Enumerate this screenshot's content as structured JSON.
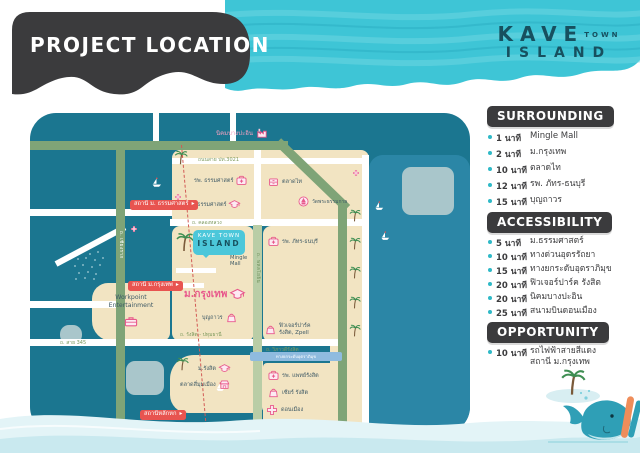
{
  "colors": {
    "accent_cyan": "#3ec5d6",
    "dark": "#3b3b3d",
    "map_water": "#1b7690",
    "land": "#f2e4c2",
    "pink": "#e8598c",
    "badge_red": "#e85450",
    "road_green": "#7fa477"
  },
  "header": {
    "title": "PROJECT LOCATION"
  },
  "brand": {
    "line1": "KAVE",
    "line1b": "TOWN",
    "line2": "ISLAND"
  },
  "sections": {
    "surrounding": {
      "title": "SURROUNDING",
      "items": [
        {
          "time": "1 นาที",
          "place": "Mingle Mall"
        },
        {
          "time": "2 นาที",
          "place": "ม.กรุงเทพ"
        },
        {
          "time": "10 นาที",
          "place": "ตลาดไท"
        },
        {
          "time": "12 นาที",
          "place": "รพ. ภัทร-ธนบุรี"
        },
        {
          "time": "15 นาที",
          "place": "บุญถาวร"
        }
      ]
    },
    "accessibility": {
      "title": "ACCESSIBILITY",
      "items": [
        {
          "time": "5 นาที",
          "place": "ม.ธรรมศาสตร์"
        },
        {
          "time": "10 นาที",
          "place": "ทางด่วนอุดรรัถยา"
        },
        {
          "time": "15 นาที",
          "place": "ทางยกระดับอุตราภิมุข"
        },
        {
          "time": "20 นาที",
          "place": "ฟิวเจอร์ปาร์ค รังสิต"
        },
        {
          "time": "20 นาที",
          "place": "นิคมบางปะอิน"
        },
        {
          "time": "25 นาที",
          "place": "สนามบินดอนเมือง"
        }
      ]
    },
    "opportunity": {
      "title": "OPPORTUNITY",
      "items": [
        {
          "time": "10 นาที",
          "place": "รถไฟฟ้าสายสีแดง",
          "place_line2": "สถานี ม.กรุงเทพ"
        }
      ]
    }
  },
  "map": {
    "stations": {
      "thammasat": "สถานี ม. ธรรมศาสตร์",
      "bangkok_u": "สถานี ม.กรุงเทพ",
      "lak_hok": "สถานีหลักหก"
    },
    "pois": {
      "nikhom_bang_pa_in": "นิคมบางปะอิน",
      "thammasat_hospital": "รพ. ธรรมศาสตร์",
      "talad_thai": "ตลาดไท",
      "thammasat_university": "ม. ธรรมศาสตร์",
      "wat_phra_dhammakaya": "วัดพระธรรมกาย",
      "mingle_mall": "Mingle Mall",
      "pathara_thonburi_hospital": "รพ. ภัทร-ธนบุรี",
      "bangkok_university": "ม.กรุงเทพ",
      "boonthavorn": "บุญถาวร",
      "workpoint_line1": "Workpoint",
      "workpoint_line2": "Entertainment",
      "future_park_line1": "ฟิวเจอร์ปาร์ค",
      "future_park_line2": "รังสิต, Zpell",
      "rangsit_university": "ม.รังสิต",
      "si_mum_mueang_market": "ตลาดสี่มุมเมือง",
      "patrangsit_hospital": "รพ. แพทย์รังสิต",
      "zeer_rangsit": "เซียร์ รังสิต",
      "don_mueang": "ดอนเมือง"
    },
    "kave": {
      "line1": "KAVE TOWN",
      "line2": "ISLAND"
    },
    "roads": {
      "pt3021": "ถนนสาย ปท.3021",
      "khlong_luang": "ถ. คลองหลวง",
      "phahonyothin": "ถ. พหลโยธิน",
      "chiang_rak": "ถ. เชียงราก",
      "sai_345": "ถ. สาย 345",
      "rangsit_pathum": "ถ. รังสิต - ปทุมธานี",
      "viphavadi": "ถ. วิภาวดีรังสิต",
      "tollway": "ทางยกระดับอุตราภิมุข"
    }
  },
  "icons": {
    "station_arrow": "▸"
  }
}
